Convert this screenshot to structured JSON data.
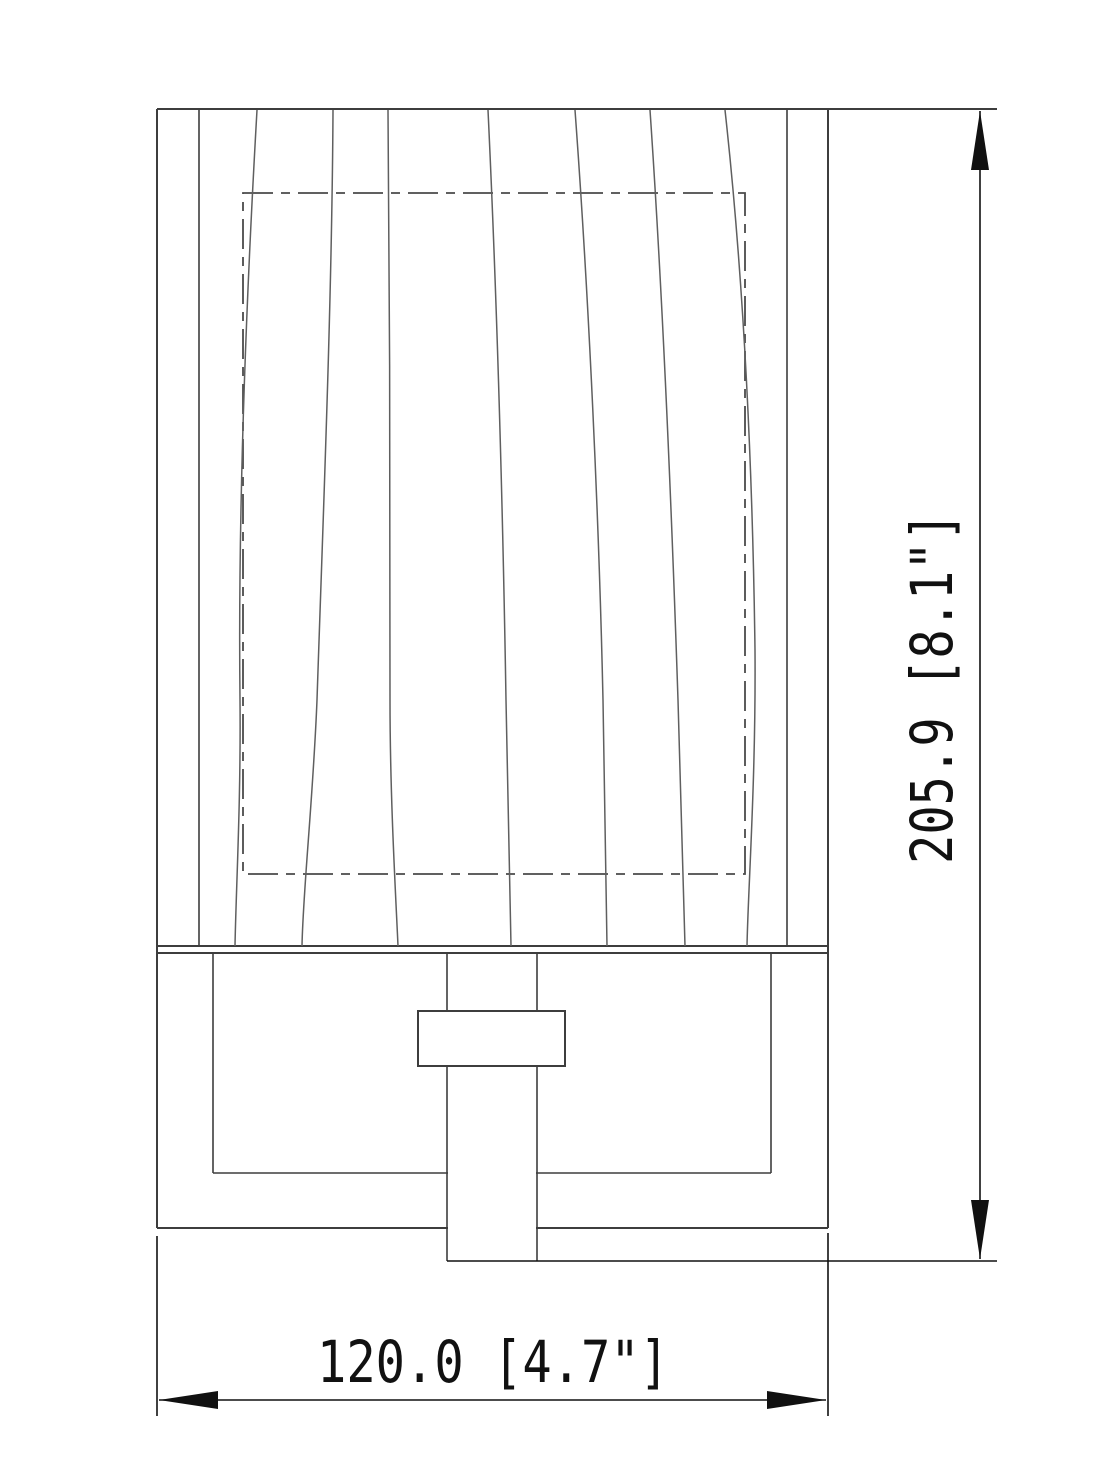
{
  "drawing": {
    "kind": "technical-line-drawing",
    "dimensions": {
      "height": {
        "label": "205.9 [8.1\"]",
        "millimeters": "205.9",
        "inches": "8.1\""
      },
      "width": {
        "label": "120.0 [4.7\"]",
        "millimeters": "120.0",
        "inches": "4.7\""
      }
    },
    "colors": {
      "background": "#ffffff",
      "outline": "#3d3d3d",
      "pattern_lines": "#5f5f5f",
      "hidden_lines": "#4a4a4a",
      "dimension": "#111111"
    }
  }
}
